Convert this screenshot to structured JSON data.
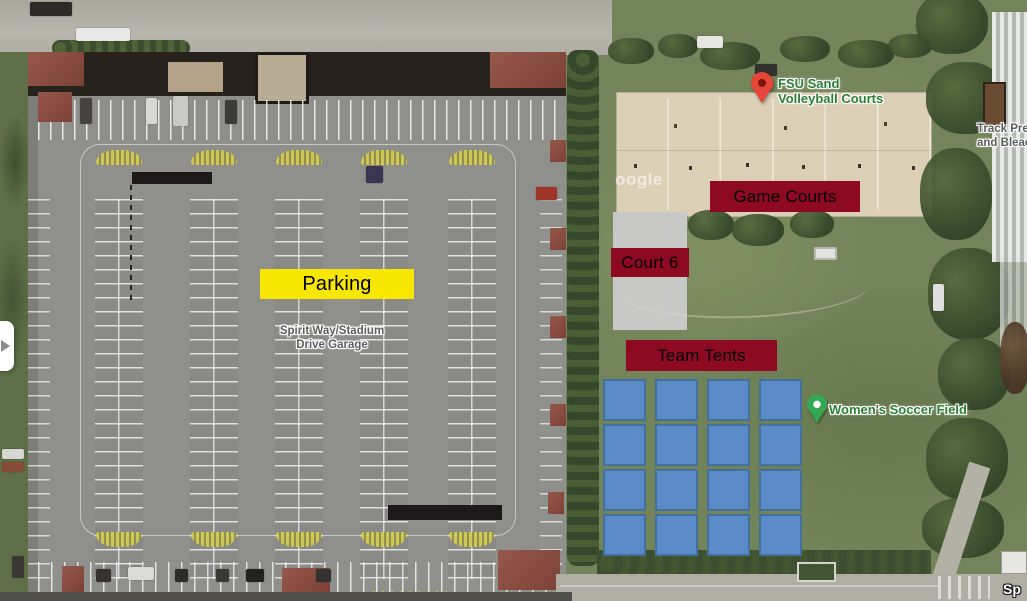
{
  "map": {
    "google_watermark_partial": "oogle",
    "street_label_partial": "Sp"
  },
  "pins": {
    "fsu": {
      "title_line1": "FSU Sand",
      "title_line2": "Volleyball Courts",
      "pin_color": "#e8453a",
      "pin_inner_color": "#7c1710"
    },
    "womens": {
      "title": "Women's Soccer Field",
      "pin_color": "#34a853",
      "pin_inner_color": "#ffffff"
    }
  },
  "place_labels": {
    "garage_line1": "Spirit Way/Stadium",
    "garage_line2": "Drive Garage",
    "track_line1": "Track Pres",
    "track_line2": "and Bleac"
  },
  "annotations": {
    "parking": {
      "label": "Parking",
      "bg": "#f7e600",
      "text_color": "#000000"
    },
    "game_courts": {
      "label": "Game Courts",
      "bg": "#8e0922",
      "text_color": "#000000"
    },
    "court6": {
      "label": "Court 6",
      "bg": "#8e0922",
      "text_color": "#000000"
    },
    "team_tents": {
      "label": "Team Tents",
      "bg": "#8e0922",
      "text_color": "#000000"
    },
    "tents_grid": {
      "rows": 4,
      "cols": 4,
      "fill": "#5b8ac8",
      "border": "#41719c"
    }
  }
}
